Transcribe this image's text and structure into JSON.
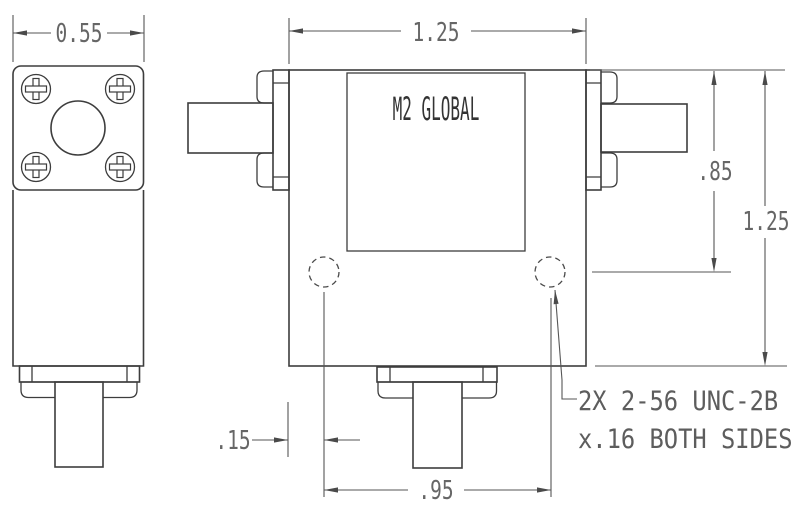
{
  "drawing": {
    "brand": "M2 GLOBAL",
    "dimensions": {
      "side_width": "0.55",
      "front_width": "1.25",
      "holes_from_top": ".85",
      "front_height": "1.25",
      "hole_edge_offset": ".15",
      "hole_spacing": ".95"
    },
    "note": {
      "line1": "2X 2-56 UNC-2B",
      "line2": "x.16 BOTH SIDES"
    },
    "colors": {
      "background": "#ffffff",
      "object_line": "#3d3d3d",
      "dimension_line": "#565656",
      "text": "#666666"
    }
  }
}
